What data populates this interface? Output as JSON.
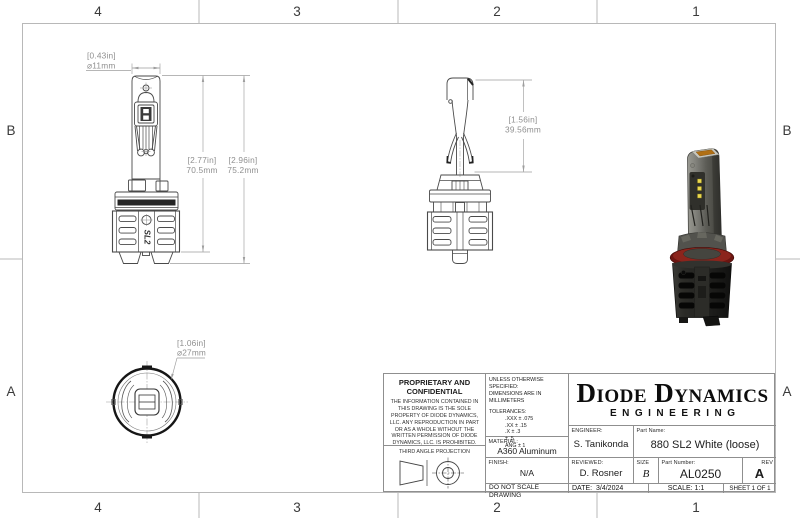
{
  "sheet": {
    "zone_columns": [
      "4",
      "3",
      "2",
      "1"
    ],
    "zone_rows": [
      "B",
      "A"
    ]
  },
  "dimensions": {
    "bulb_diameter": {
      "inches": "[0.43in]",
      "metric": "⌀11mm"
    },
    "body_height": {
      "inches": "[2.77in]",
      "metric": "70.5mm"
    },
    "total_height": {
      "inches": "[2.96in]",
      "metric": "75.2mm"
    },
    "stem_height": {
      "inches": "[1.56in]",
      "metric": "39.56mm"
    },
    "base_diameter": {
      "inches": "[1.06in]",
      "metric": "⌀27mm"
    }
  },
  "part_logo": "SL2",
  "title_block": {
    "proprietary": {
      "heading": "PROPRIETARY AND CONFIDENTIAL",
      "body": "THE INFORMATION CONTAINED IN THIS DRAWING IS THE SOLE PROPERTY OF DIODE DYNAMICS, LLC.  ANY REPRODUCTION IN PART OR AS A WHOLE WITHOUT THE WRITTEN PERMISSION OF DIODE DYNAMICS, LLC. IS PROHIBITED.",
      "projection_label": "THIRD ANGLE PROJECTION"
    },
    "specs": {
      "unless": "UNLESS OTHERWISE SPECIFIED:",
      "units": "DIMENSIONS ARE IN MILLIMETERS",
      "tolerances_label": "TOLERANCES:",
      "tolerances": [
        ".XXX ± .075",
        ".XX ± .15",
        ".X ± .3",
        "± .5",
        "ANG ± 1"
      ],
      "material_label": "MATERIAL:",
      "material": "A360 Aluminum",
      "finish_label": "FINISH:",
      "finish": "N/A",
      "do_not_scale": "DO NOT SCALE DRAWING"
    },
    "company": {
      "name": "Diode Dynamics",
      "division": "ENGINEERING"
    },
    "engineer_label": "ENGINEER:",
    "engineer": "S. Tanikonda",
    "part_name_label": "Part Name:",
    "part_name": "880 SL2 White (loose)",
    "reviewed_label": "REVIEWED:",
    "reviewed": "D. Rosner",
    "size_label": "SIZE",
    "size": "B",
    "part_number_label": "Part Number:",
    "part_number": "AL0250",
    "rev_label": "REV",
    "rev": "A",
    "date_label": "DATE:",
    "date": "3/4/2024",
    "scale": "SCALE: 1:1",
    "sheet": "SHEET 1 OF 1"
  },
  "colors": {
    "line": "#4a4a4a",
    "dimension": "#8f8f8f",
    "frame": "#b8b8b8",
    "gasket_red": "#7a1b15",
    "heatsink_black": "#1d1d1a",
    "led_amber": "#b06f14"
  }
}
